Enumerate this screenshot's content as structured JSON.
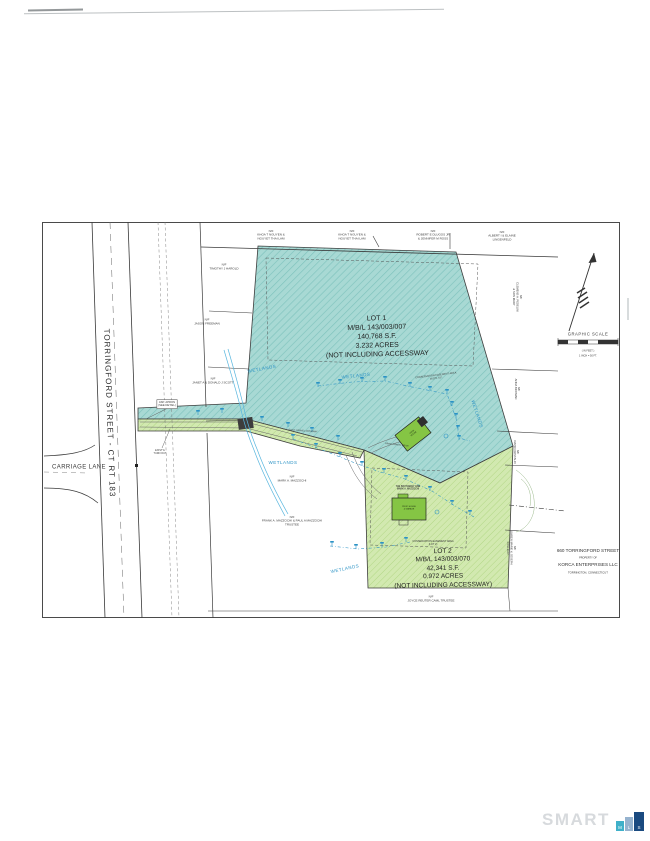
{
  "plan": {
    "streets": {
      "torringford": "TORRINGFORD STREET - CT RT 183",
      "carriage": "CARRIAGE LANE"
    },
    "lot1": {
      "label": "LOT 1\nM/B/L 143/003/007\n140,768 S.F.\n3.232 ACRES\n(NOT INCLUDING ACCESSWAY"
    },
    "lot2": {
      "label": "LOT 2\nM/B/L 143/003/070\n42,341 S.F.\n0.972 ACRES\n(NOT INCLUDING ACCESSWAY)"
    },
    "abutters": {
      "top": [
        "N/F\nKHOA T NGUYEN &\nNGUYET THAI LAM",
        "N/F\nKHOA T NGUYEN &\nNGUYET THAI LAM",
        "N/F\nROBERT E DLUGOS JR\n& JENNIFER M ROSS",
        "N/F\nALBERT I & ELAINE\nLINGENFELD"
      ],
      "west": [
        "N/F\nTIMOTHY J HAROLD",
        "N/F\nJASON FREEMAN",
        "N/F\nJANET A & DONALD J SCOTT"
      ],
      "south": [
        "N/F\nMARK A. MAZZOCHI",
        "N/F\nFRANK A. MAZZOCHI & PAUL A MAZZOCHI\nTRUSTEE",
        "N/F\nJOYCE REUTER CAML TRUSTEE"
      ],
      "east": [
        "N/F\nCLEMENS A. PEDELINI\n& SON MARY",
        "N/F\nANNA BICKMAN",
        "N/F\nDAVID CRISTALDI",
        "N/F\nKAREN MARIE & JOSEPH\nCOLLELO"
      ]
    },
    "wetlands": [
      "WETLANDS",
      "WETLANDS",
      "WETLANDS",
      "WETLANDS",
      "WETLANDS"
    ],
    "easements": {
      "lot1": "CONSERVATION EASEMENT AREA\n46,071 S.F.",
      "lot2": "CONSERVATION EASEMENT AREA\n(LOT 2)"
    },
    "notes": {
      "apron": "ASP. APRON\n(SEE DETAIL)",
      "turnout": "EXIST'G\nTURN OUT",
      "drive_exist": "EXIST. GRAVEL DRIVEWAY",
      "drive_prop": "PROP. GRAVEL DRIVE",
      "southerly": "THE SOUTHERLY LINE\nMARK A. MAZZOCHI",
      "house1": "PROP.\nHOUSE",
      "house2": "PROP. HOUSE\n& GARAGE"
    },
    "north_scale": {
      "title": "GRAPHIC SCALE",
      "in_feet": "( IN FEET )",
      "ratio": "1 INCH = 50 FT."
    },
    "title_block": {
      "line1": "660 TORRINGFORD STREET",
      "line2": "PROPERTY OF",
      "line3": "KORCA ENTERPRISES LLC",
      "line4": "TORRINGTON, CONNECTICUT"
    }
  },
  "watermark": {
    "smart": "SMART",
    "m": "M",
    "l": "L",
    "s": "S"
  },
  "colors": {
    "lot1_fill": "#a8d9d4",
    "lot1_hatch": "#7fc3bd",
    "lot2_fill": "#d2e9b0",
    "lot2_hatch": "#b2d785",
    "wetland_blue": "#2a92c5",
    "building_green": "#85c544",
    "smart_gray": "#d7dadd",
    "mls_m": "#3fb0c9",
    "mls_l": "#96b3cf",
    "mls_s": "#1a4a80"
  }
}
